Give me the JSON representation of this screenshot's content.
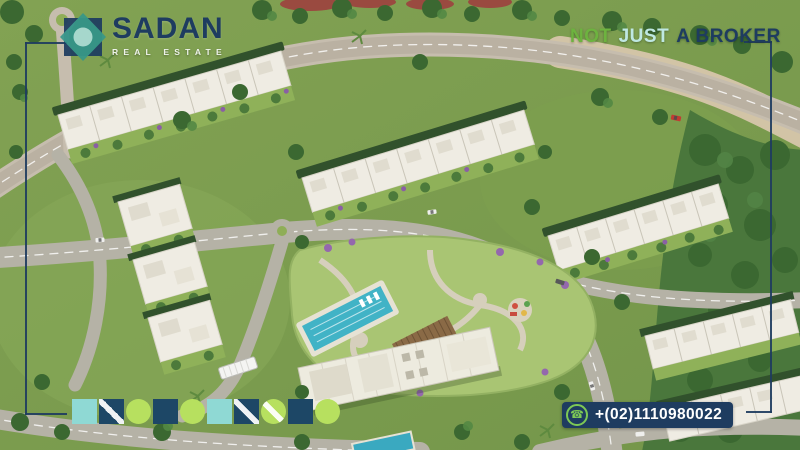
{
  "brand": {
    "name": "SADAN",
    "subtitle": "REAL ESTATE",
    "logo_icon": "sadan-diamond-logo-icon",
    "colors": {
      "navy": "#1e3c60",
      "teal": "#2f948a",
      "light_cyan": "#9fd9d3",
      "lime": "#b7e05f",
      "green": "#6db33f"
    }
  },
  "tagline": {
    "words": [
      {
        "text": "NOT",
        "color": "#6db33f"
      },
      {
        "text": "JUST",
        "color": "#bfe8e2"
      },
      {
        "text": "A BROKER",
        "color": "#1e3c60"
      }
    ]
  },
  "contact": {
    "phone_number": "+(02)1110980022",
    "phone_icon": "phone-call-icon",
    "phone_icon_glyph": "☎",
    "icon_green": "#7dc855",
    "badge_bg": "#1e3c60"
  },
  "decor": {
    "frame_color": "#1e3c60",
    "shapes": [
      {
        "type": "square",
        "fill": "#8fd9d4"
      },
      {
        "type": "square",
        "stripe": true,
        "fill": "#1d4766"
      },
      {
        "type": "circle",
        "fill": "#b7e05f"
      },
      {
        "type": "square",
        "fill": "#1d4766"
      },
      {
        "type": "circle",
        "fill": "#b7e05f"
      },
      {
        "type": "square",
        "fill": "#8fd9d4"
      },
      {
        "type": "square",
        "stripe": true,
        "fill": "#1d4766"
      },
      {
        "type": "circle",
        "stripe": true,
        "fill": "#b7e05f"
      },
      {
        "type": "square",
        "fill": "#1d4766"
      },
      {
        "type": "circle",
        "fill": "#b7e05f"
      }
    ]
  },
  "scene": {
    "description": "Aerial 3D master-plan render of a residential compound: rows of white villas, central landscaped park with swimming pool and clubhouse, curving roads and dense trees"
  }
}
